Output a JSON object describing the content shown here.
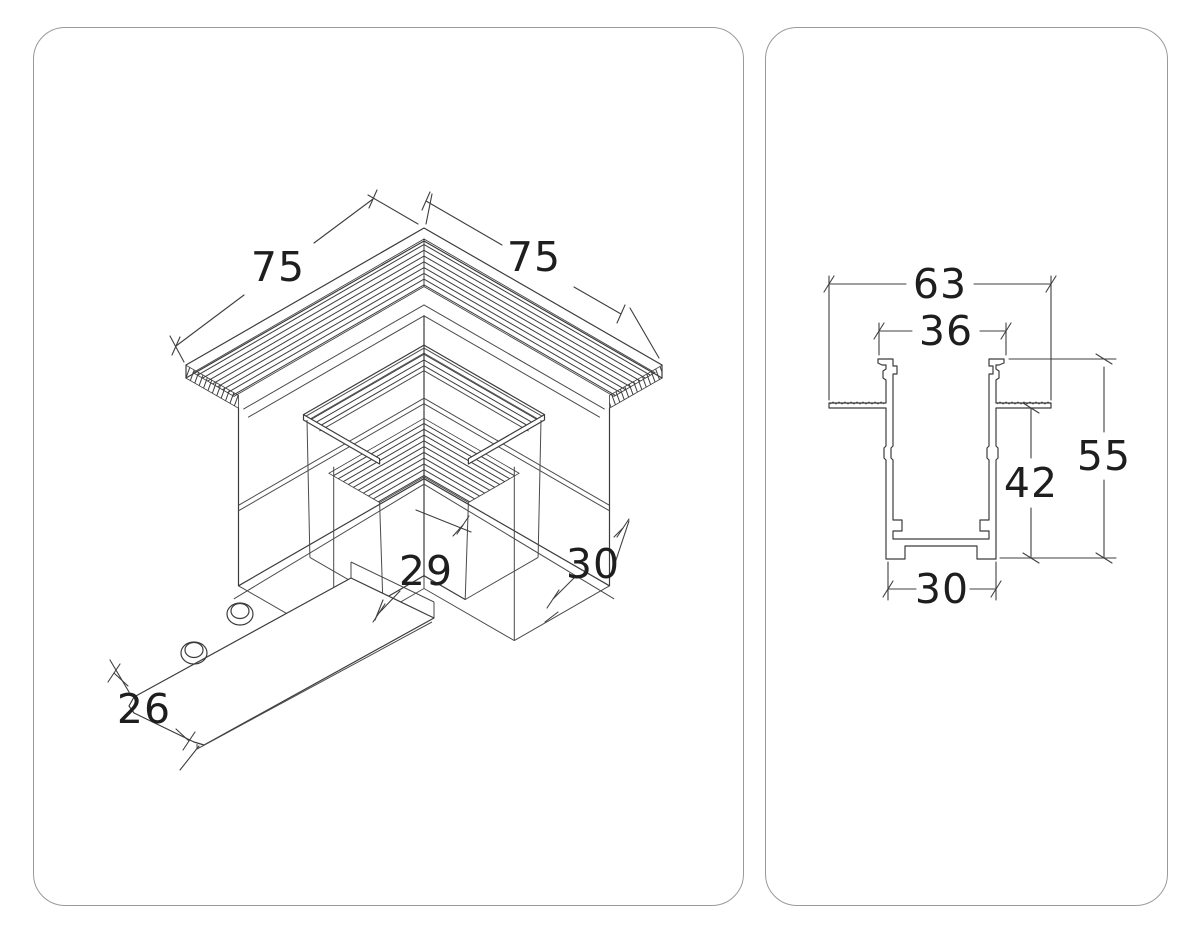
{
  "page": {
    "background": "#ffffff",
    "panel_border_color": "#9a9a9a",
    "line_color": "#3c3c3c",
    "text_color": "#1e1e1e"
  },
  "left_panel": {
    "name": "corner-connector-isometric-drawing",
    "dimensions": {
      "top_left_edge": "75",
      "top_right_edge": "75",
      "inner_channel_width": "29",
      "outer_channel_width": "30",
      "mounting_plate_width": "26"
    }
  },
  "right_panel": {
    "name": "profile-cross-section-drawing",
    "dimensions": {
      "overall_width": "63",
      "opening_width": "36",
      "recess_depth": "42",
      "overall_height": "55",
      "base_width": "30"
    }
  }
}
